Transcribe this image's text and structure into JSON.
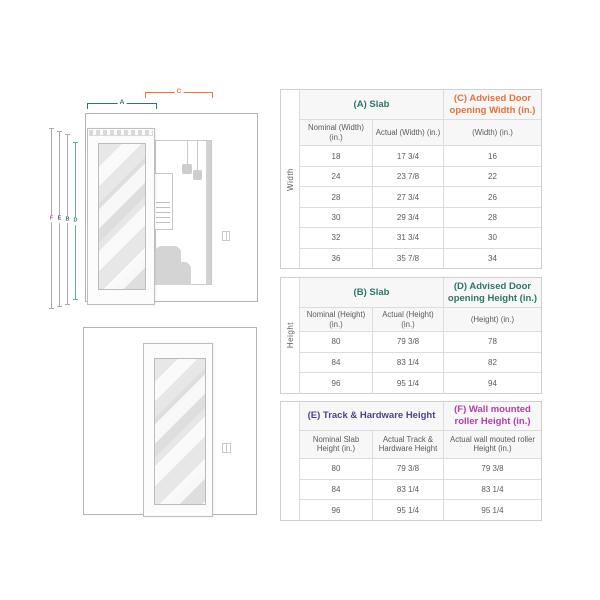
{
  "colors": {
    "teal": "#2E7568",
    "teal_line": "#63AC9F",
    "orange": "#E8713C",
    "indigo": "#4A4587",
    "magenta": "#B23FA9"
  },
  "diagram": {
    "labels": {
      "A": "A",
      "B": "B",
      "C": "C",
      "D": "D",
      "E": "E",
      "F": "F"
    }
  },
  "tables": [
    {
      "id": "width",
      "side_label": "Width",
      "group_a": {
        "label": "(A) Slab",
        "color": "#2E7568"
      },
      "group_b": {
        "label": "(C) Advised Door opening Width (in.)",
        "color": "#E8713C"
      },
      "col_headers": [
        "Nominal (Width) (in.)",
        "Actual (Width) (in.)",
        "(Width) (in.)"
      ],
      "rows": [
        [
          "18",
          "17 3/4",
          "16"
        ],
        [
          "24",
          "23 7/8",
          "22"
        ],
        [
          "28",
          "27 3/4",
          "26"
        ],
        [
          "30",
          "29 3/4",
          "28"
        ],
        [
          "32",
          "31 3/4",
          "30"
        ],
        [
          "36",
          "35 7/8",
          "34"
        ]
      ]
    },
    {
      "id": "height",
      "side_label": "Height",
      "group_a": {
        "label": "(B) Slab",
        "color": "#2E7568"
      },
      "group_b": {
        "label": "(D) Advised Door opening Height (in.)",
        "color": "#2E7568"
      },
      "col_headers": [
        "Nominal (Height) (in.)",
        "Actual (Height) (in.)",
        "(Height) (in.)"
      ],
      "rows": [
        [
          "80",
          "79 3/8",
          "78"
        ],
        [
          "84",
          "83 1/4",
          "82"
        ],
        [
          "96",
          "95 1/4",
          "94"
        ]
      ]
    },
    {
      "id": "track",
      "side_label": "",
      "group_a": {
        "label": "(E) Track & Hardware Height",
        "color": "#4A4587"
      },
      "group_b": {
        "label": "(F) Wall mounted roller Height (in.)",
        "color": "#B23FA9"
      },
      "col_headers": [
        "Nominal Slab Height (in.)",
        "Actual Track & Hardware Height",
        "Actual wall mouted roller Height (in.)"
      ],
      "rows": [
        [
          "80",
          "79 3/8",
          "79 3/8"
        ],
        [
          "84",
          "83 1/4",
          "83 1/4"
        ],
        [
          "96",
          "95 1/4",
          "95 1/4"
        ]
      ]
    }
  ]
}
